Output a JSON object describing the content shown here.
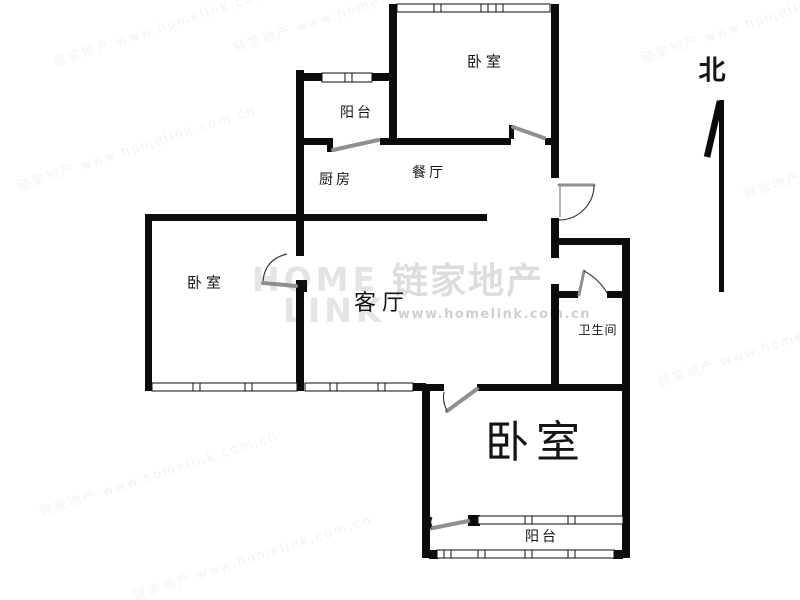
{
  "colors": {
    "wall": "#0c0c0c",
    "door_leaf": "#8f8f8f",
    "door_arc": "#3c3c3c",
    "label": "#151515",
    "watermark_latin": "#e4e4e4",
    "watermark_cjk": "#dddddd",
    "watermark_url": "#cfcfcf",
    "watermark_tile": "rgba(0,0,0,0.05)",
    "bg": "#ffffff"
  },
  "compass": {
    "label": "北"
  },
  "rooms": {
    "bedroom_top": "卧室",
    "balcony_top": "阳台",
    "kitchen": "厨房",
    "dining": "餐厅",
    "living": "客厅",
    "bedroom_left": "卧室",
    "bathroom": "卫生间",
    "bedroom_bottom": "卧室",
    "balcony_bottom": "阳台"
  },
  "watermark": {
    "latin_line1": "HOME",
    "latin_line2": "LINK",
    "cjk": "链家地产",
    "url": "www.homelink.com.cn",
    "tile": "链家地产 www.homelink.com.cn"
  }
}
